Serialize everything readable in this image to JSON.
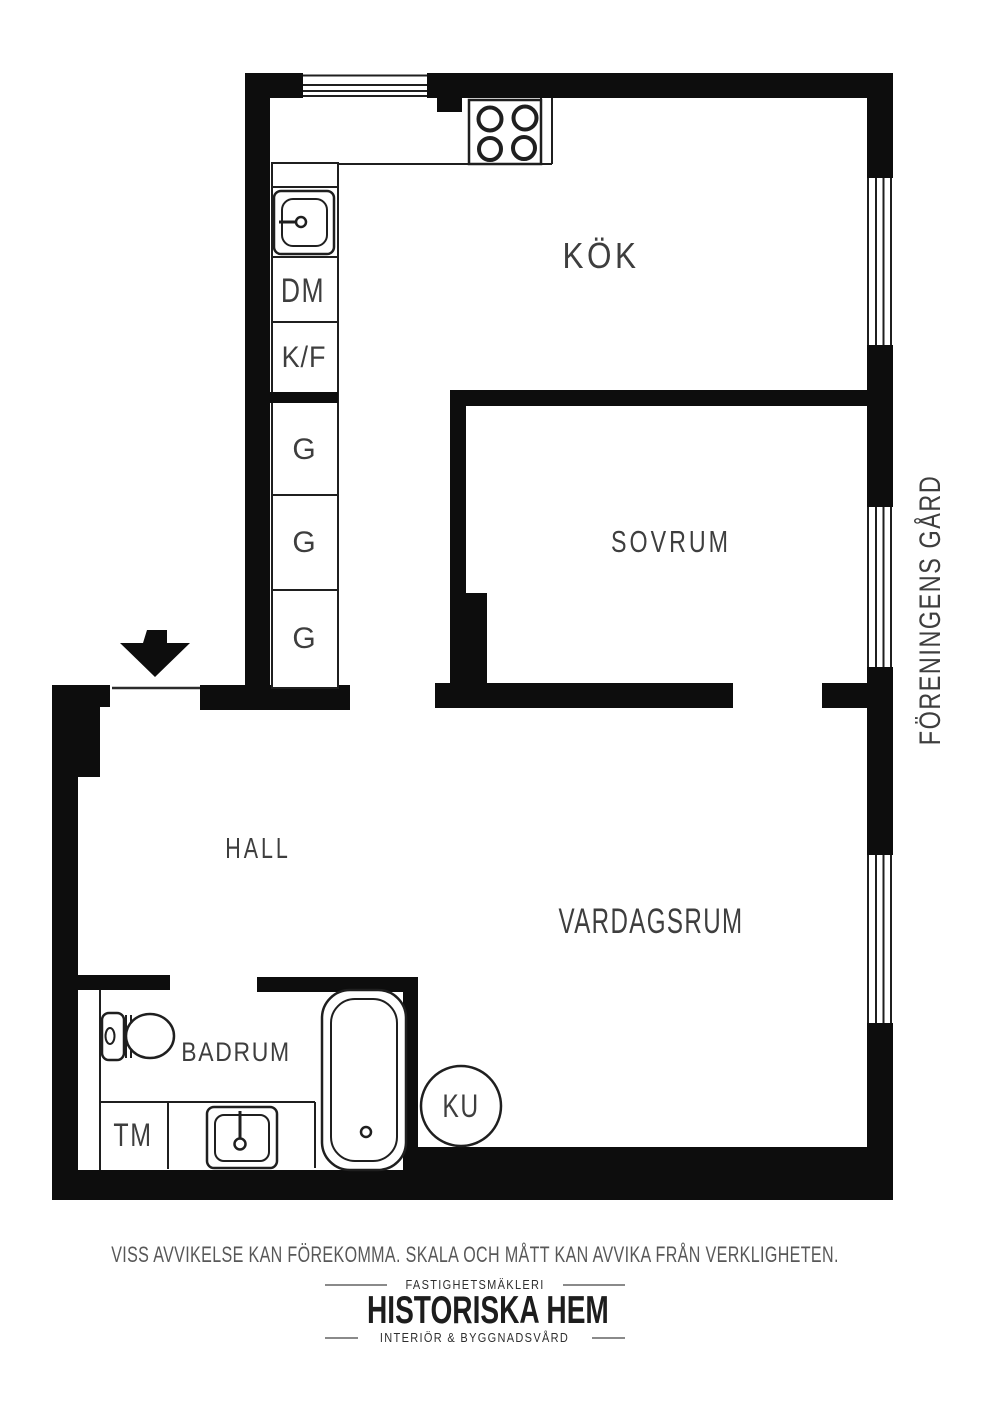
{
  "plan": {
    "rooms": {
      "kok": {
        "label": "KÖK"
      },
      "sovrum": {
        "label": "SOVRUM"
      },
      "hall": {
        "label": "HALL"
      },
      "vardagsrum": {
        "label": "VARDAGSRUM"
      },
      "badrum": {
        "label": "BADRUM"
      }
    },
    "fixtures": {
      "dm": {
        "label": "DM"
      },
      "kf": {
        "label": "K/F"
      },
      "g1": {
        "label": "G"
      },
      "g2": {
        "label": "G"
      },
      "g3": {
        "label": "G"
      },
      "tm": {
        "label": "TM"
      },
      "ku": {
        "label": "KU"
      }
    },
    "exterior": {
      "courtyard_label": "FÖRENINGENS GÅRD"
    },
    "colors": {
      "wall": "#0d0d0d",
      "line": "#1f1f1f",
      "label": "#3e3e3e",
      "background": "#ffffff"
    }
  },
  "footer": {
    "disclaimer": "VISS AVVIKELSE KAN FÖREKOMMA. SKALA OCH MÅTT KAN AVVIKA FRÅN VERKLIGHETEN.",
    "logo": {
      "tagline_top": "FASTIGHETSMÄKLERI",
      "name": "HISTORISKA HEM",
      "tagline_bottom": "INTERIÖR & BYGGNADSVÅRD"
    }
  }
}
